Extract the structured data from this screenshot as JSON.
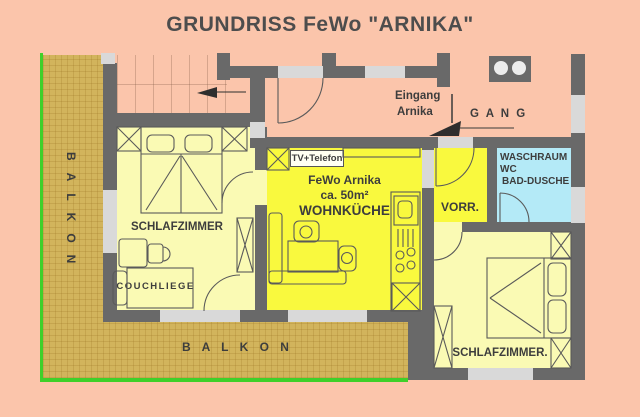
{
  "title": "GRUNDRISS FeWo \"ARNIKA\"",
  "balcony": {
    "left_label": "BALKON",
    "bottom_label": "B A L K O N"
  },
  "corridor": {
    "gang_label": "G A N G",
    "eingang_line1": "Eingang",
    "eingang_line2": "Arnika"
  },
  "living_kitchen": {
    "tv_label": "TV+Telefon",
    "name": "FeWo Arnika",
    "area": "ca. 50m²",
    "label": "WOHNKÜCHE"
  },
  "bedroom_left": {
    "label": "SCHLAFZIMMER",
    "couch_label": "COUCHLIEGE"
  },
  "bedroom_right": {
    "label": "SCHLAFZIMMER."
  },
  "vorraum": {
    "label": "VORR."
  },
  "washroom": {
    "line1": "WASCHRAUM",
    "line2": "WC",
    "line3": "BAD-DUSCHE"
  },
  "colors": {
    "background": "#fbc5ab",
    "wall": "#696969",
    "window_light": "#d9d9d9",
    "room_pale_yellow": "#fafab4",
    "room_bright_yellow": "#f9f93e",
    "washroom_cyan": "#b4eaf7",
    "balcony_tan": "#d2b45c",
    "balcony_green": "#3fd02a",
    "text_dark": "#3d3d3d"
  }
}
